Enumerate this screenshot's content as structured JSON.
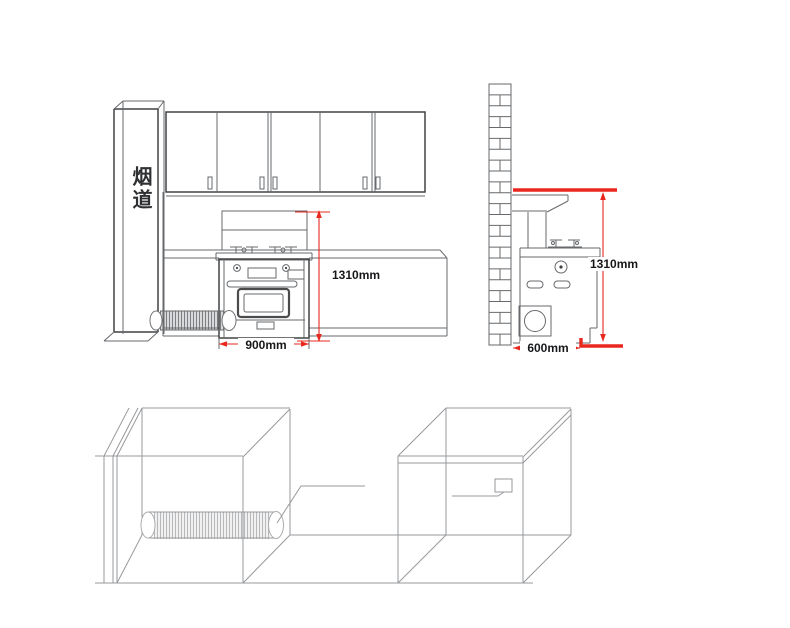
{
  "diagram": {
    "title_hint": "integrated stove installation dimension diagram",
    "front_view": {
      "flue_label": "烟道",
      "height_dimension": "1310mm",
      "width_dimension": "900mm"
    },
    "side_view": {
      "height_dimension": "1310mm",
      "depth_dimension": "600mm"
    }
  },
  "colors": {
    "dimension_red": "#e8281e",
    "drawing_dark": "#404245",
    "drawing_gray": "#67696c",
    "drawing_light": "#97999c",
    "text_color": "#17181a",
    "background": "#ffffff"
  }
}
